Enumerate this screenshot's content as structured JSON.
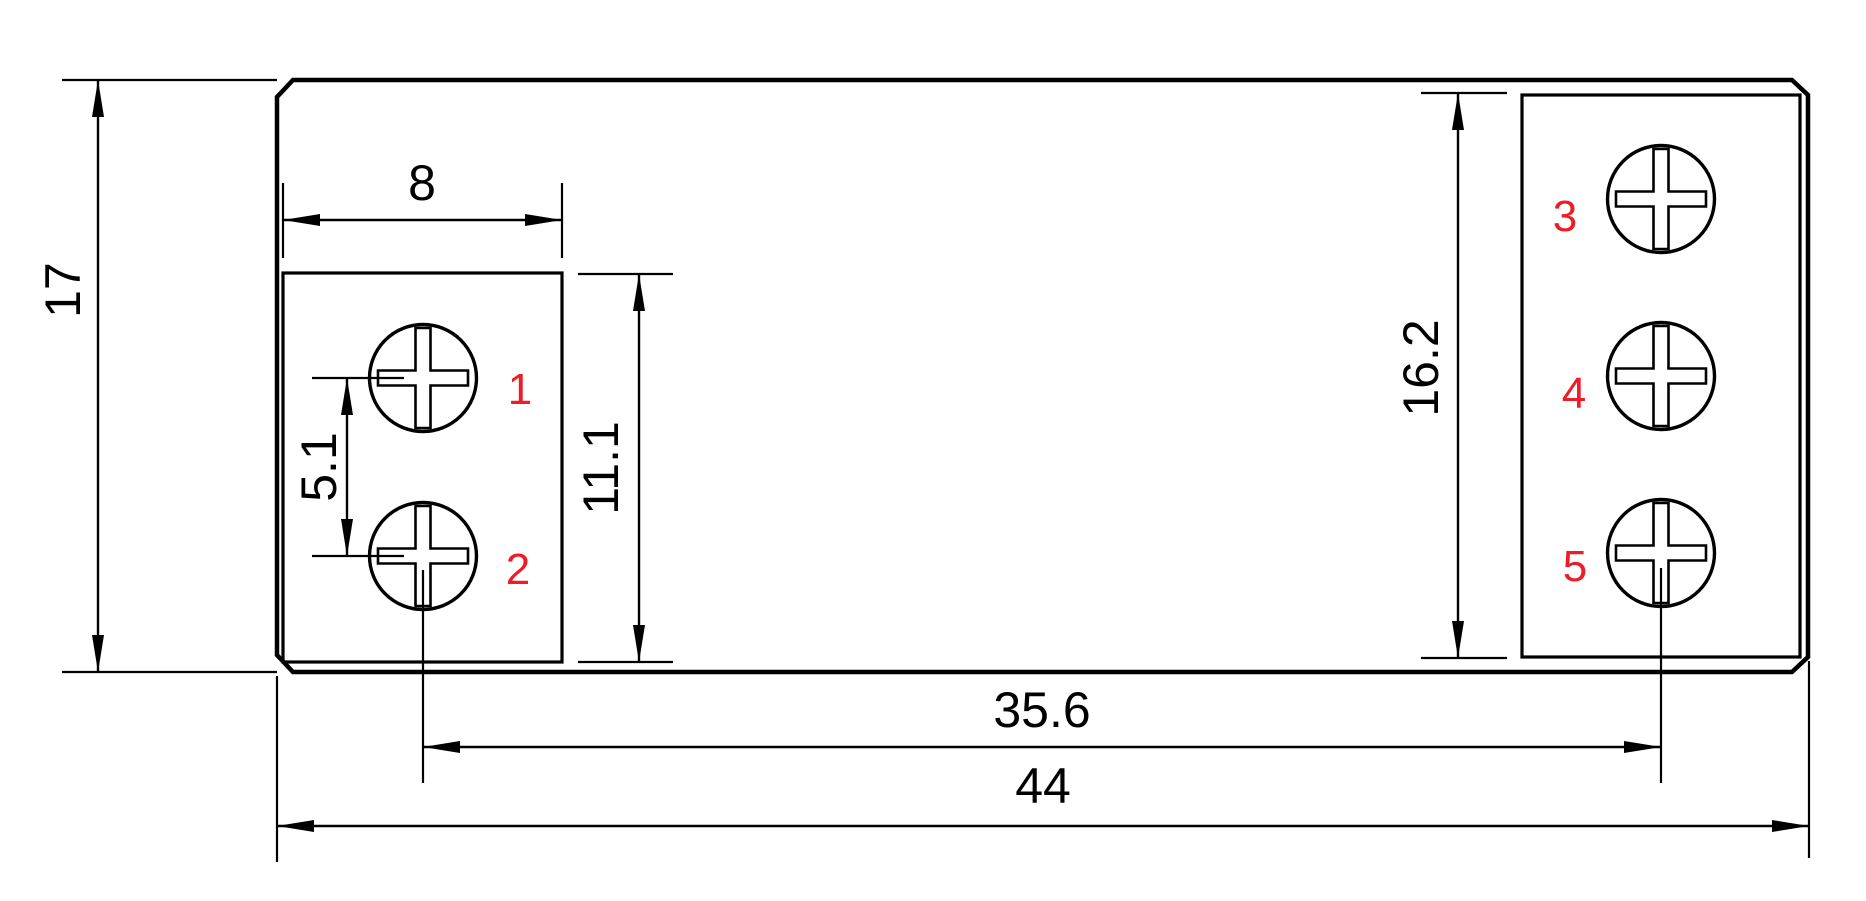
{
  "page": {
    "background": "#ffffff"
  },
  "drawing": {
    "line_color": "#000000",
    "terminal_label_color": "#ee1c25",
    "dimensions": {
      "overall_height": "17",
      "left_block_width": "8",
      "left_screw_pitch": "5.1",
      "left_block_height": "11.1",
      "right_strip_height": "16.2",
      "screw_center_span": "35.6",
      "overall_width": "44"
    },
    "terminals": [
      {
        "label": "1"
      },
      {
        "label": "2"
      },
      {
        "label": "3"
      },
      {
        "label": "4"
      },
      {
        "label": "5"
      }
    ]
  }
}
